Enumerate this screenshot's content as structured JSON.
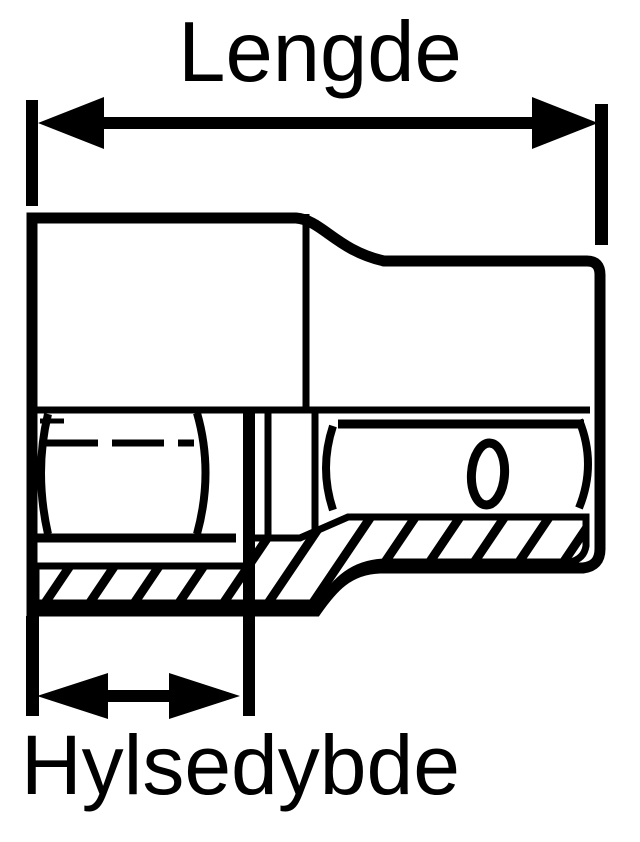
{
  "diagram": {
    "labels": {
      "length": "Lengde",
      "socket_depth": "Hylsedybde"
    },
    "colors": {
      "line": "#000000",
      "background": "#ffffff"
    }
  }
}
